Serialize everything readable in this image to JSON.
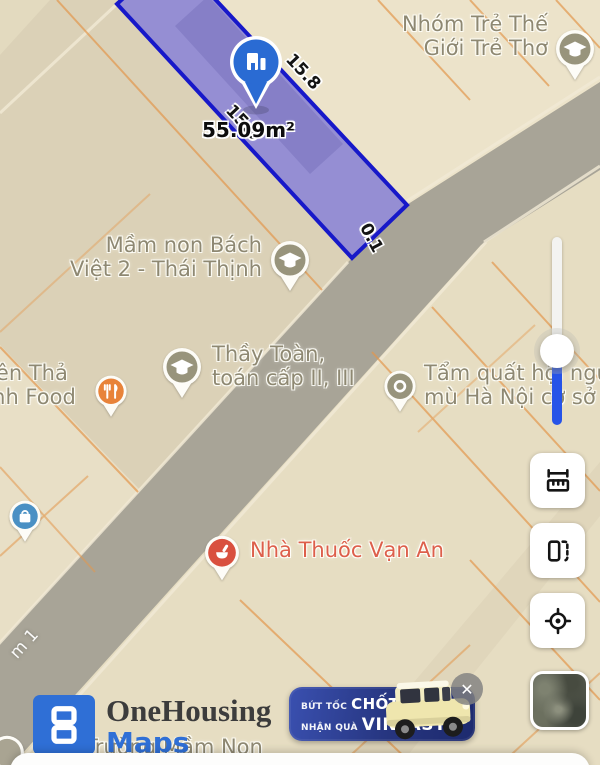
{
  "map": {
    "parcel": {
      "area": "55.09m²",
      "dim_right": "15.8",
      "dim_left": "15.9",
      "dim_front": "0.1"
    },
    "street": "m 1",
    "pois": {
      "nhom_tre": {
        "line1": "Nhóm Trẻ Thế",
        "line2": "Giới Trẻ Thơ",
        "icon": "graduation-cap-icon"
      },
      "mam_non": {
        "line1": "Mầm non Bách",
        "line2": "Việt 2 - Thái Thịnh",
        "icon": "graduation-cap-icon"
      },
      "thay_toan": {
        "line1": "Thầy Toàn,",
        "line2": "toán cấp II, III",
        "icon": "graduation-cap-icon"
      },
      "minh_food": {
        "line1": "Viên Thả",
        "line2": "Minh Food",
        "icon": "restaurant-icon"
      },
      "tam_quat": {
        "line1": "Tẩm quất hội người",
        "line2": "mù Hà Nội cơ sở 2",
        "icon": "dot-icon"
      },
      "pharmacy": {
        "line1": "Nhà Thuốc Vạn An",
        "icon": "pharmacy-icon"
      },
      "truong_mam_non": {
        "line1": "Trường Mầm Non",
        "icon": "generic-poi-icon"
      }
    }
  },
  "logo": {
    "title": "OneHousing",
    "subtitle": "Maps"
  },
  "ad": {
    "tag1": "BỨT TỐC",
    "big1": "CHỐT NHÀ",
    "tag2": "NHẬN QUÀ",
    "big2": "VINFAST",
    "close_label": "✕"
  },
  "colors": {
    "parcel_fill": "#837DD6",
    "parcel_border": "#1718C9",
    "marker_blue": "#2A6BD3",
    "slider_blue": "#2653E8",
    "brand_blue": "#2F6FD6",
    "ad_navy": "#26357F",
    "pharmacy_red": "#DD5F4B",
    "label_olive": "#8E8872",
    "road_gray": "#A8A497"
  }
}
